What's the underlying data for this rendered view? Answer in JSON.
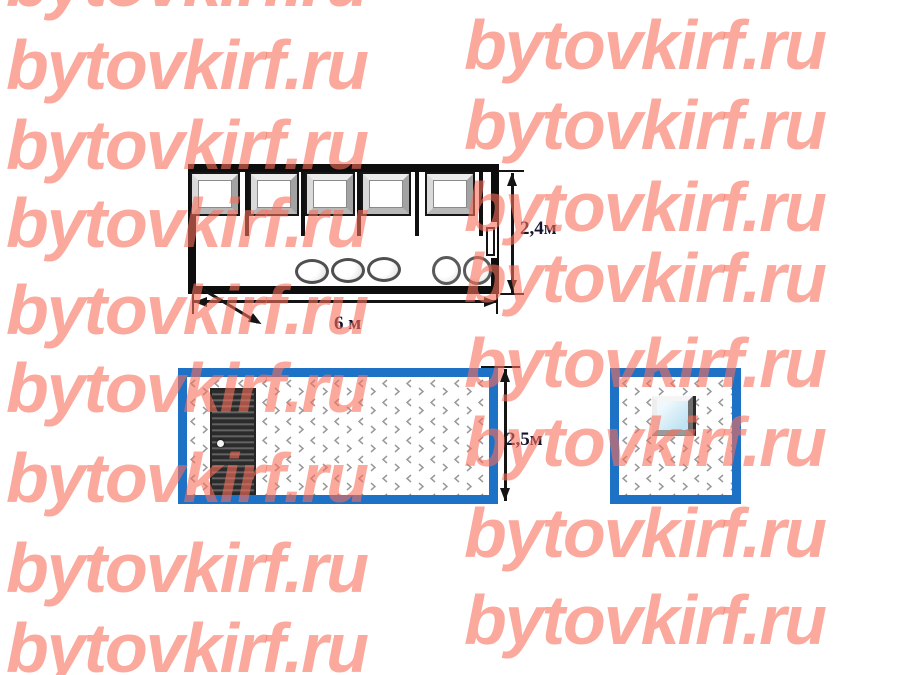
{
  "watermark": {
    "text": "bytovkirf.ru",
    "color": "rgba(248,110,92,0.6)"
  },
  "colors": {
    "frame_blue": "#1d72c6",
    "wall_black": "#0d0d0d"
  },
  "figures": {
    "floor_plan": {
      "length_label": "6 м",
      "width_label": "2,4м",
      "windows_count": 5,
      "partitions_count": 5,
      "oval_stools_count": 3,
      "round_stools_count": 2
    },
    "front_elevation": {
      "height_label": "2,5м"
    },
    "end_elevation": {}
  }
}
